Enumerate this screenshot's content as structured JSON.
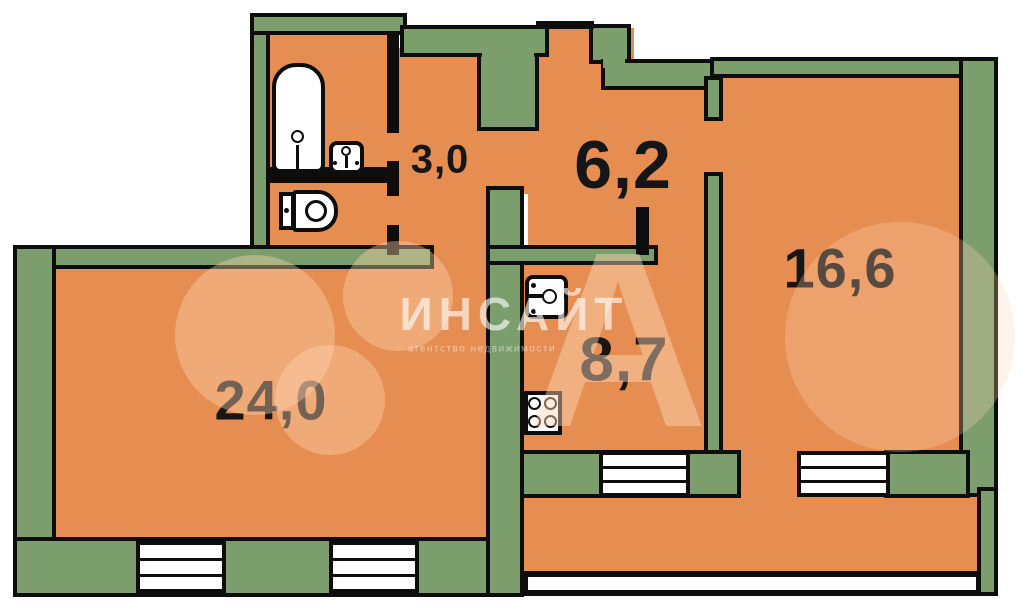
{
  "rooms": [
    {
      "name": "corridor",
      "label": "3,0"
    },
    {
      "name": "hallway",
      "label": "6,2"
    },
    {
      "name": "living-room",
      "label": "16,6"
    },
    {
      "name": "kitchen",
      "label": "8,7"
    },
    {
      "name": "main-room",
      "label": "24,0"
    }
  ],
  "fixtures": [
    "bathtub",
    "bathroom-sink",
    "toilet",
    "kitchen-sink",
    "stove"
  ],
  "watermark": {
    "title": "ИНСАЙТ",
    "subtitle": "агентство недвижимости",
    "brand_letter": "А"
  },
  "colors": {
    "wall_fill": "#7B9E6C",
    "room_fill": "#E68E52",
    "outline": "#0D0D0D",
    "window_fill": "#FFFFFF"
  }
}
